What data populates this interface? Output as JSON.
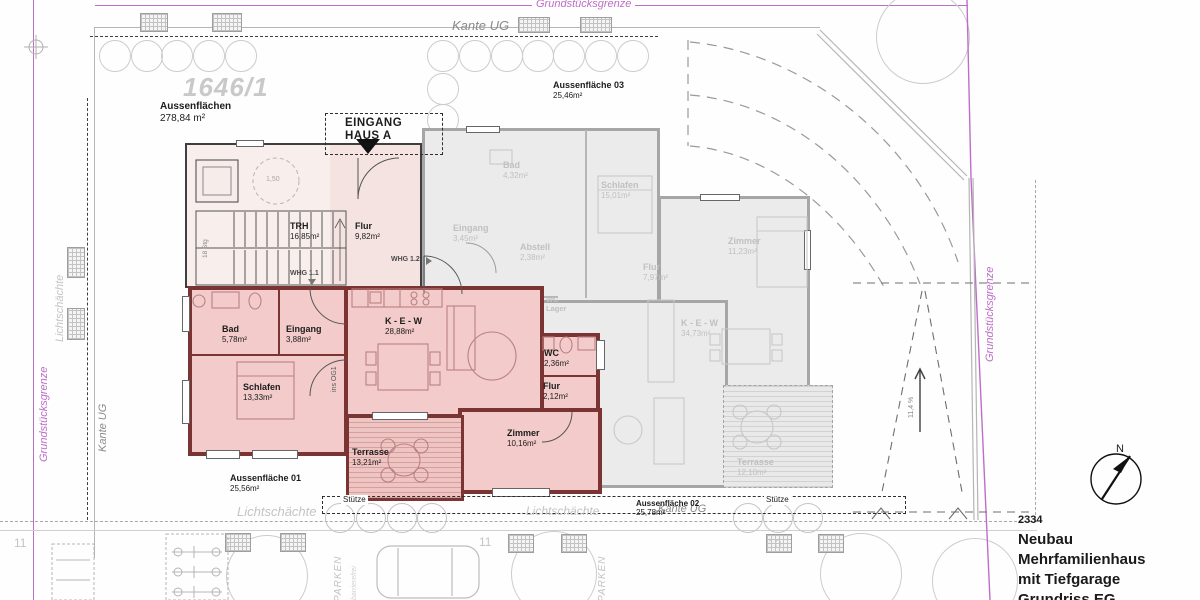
{
  "title_block": {
    "project_no": "2334",
    "line1": "Neubau",
    "line2": "Mehrfamilienhaus",
    "line3": "mit Tiefgarage",
    "line4": "Grundriss EG"
  },
  "compass": {
    "north": "N"
  },
  "boundary": {
    "grundstuecksgrenze": "Grundstücksgrenze",
    "kante_ug": "Kante UG"
  },
  "site": {
    "parcel_no": "1646/1",
    "outdoor_total": {
      "name": "Aussenflächen",
      "area": "278,84 m²"
    },
    "outdoor_01": {
      "name": "Aussenfläche 01",
      "area": "25,56m²"
    },
    "outdoor_02": {
      "name": "Aussenfläche 02",
      "area": "25,78m²"
    },
    "outdoor_03": {
      "name": "Aussenfläche 03",
      "area": "25,46m²"
    },
    "lichtschaechte": "Lichtschächte",
    "stuetze": "Stütze",
    "parken": "PARKEN",
    "barrierefrei": "barrierefrei",
    "ramp_slope": "11,4 %",
    "parking_no_11": "11",
    "parking_no_10": "10"
  },
  "entrance": {
    "line1": "EINGANG",
    "line2": "HAUS A"
  },
  "stairwell": {
    "trh": {
      "name": "TRH",
      "area": "16,85m²"
    },
    "flur": {
      "name": "Flur",
      "area": "9,82m²"
    },
    "turning_circle": "1,50",
    "stairs_note": "18 Stg",
    "to_upper_floor": "ins OG1",
    "whg11_tag": "WHG 1.1",
    "whg12_tag": "WHG 1.2"
  },
  "whg1": {
    "rooms": {
      "bad": {
        "name": "Bad",
        "area": "5,78m²"
      },
      "eingang": {
        "name": "Eingang",
        "area": "3,88m²"
      },
      "schlafen": {
        "name": "Schlafen",
        "area": "13,33m²"
      },
      "kew": {
        "name": "K - E - W",
        "area": "28,88m²"
      },
      "wc": {
        "name": "WC",
        "area": "2,36m²"
      },
      "flur": {
        "name": "Flur",
        "area": "2,12m²"
      },
      "zimmer": {
        "name": "Zimmer",
        "area": "10,16m²"
      },
      "terrasse": {
        "name": "Terrasse",
        "area": "13,21m²"
      }
    }
  },
  "whg2": {
    "rooms": {
      "bad": {
        "name": "Bad",
        "area": "4,32m²"
      },
      "schlafen": {
        "name": "Schlafen",
        "area": "15,01m²"
      },
      "eingang": {
        "name": "Eingang",
        "area": "3,45m²"
      },
      "abstell": {
        "name": "Abstell",
        "area": "2,38m²"
      },
      "wc": {
        "name": "WC"
      },
      "lager": {
        "name": "Lager"
      },
      "flur": {
        "name": "Flur",
        "area": "7,97m²"
      },
      "zimmer": {
        "name": "Zimmer",
        "area": "11,23m²"
      },
      "kew": {
        "name": "K - E - W",
        "area": "34,73m²"
      },
      "terrasse": {
        "name": "Terrasse",
        "area": "12,10m²"
      }
    }
  },
  "colors": {
    "boundary_magenta": "#bd6fc8",
    "apartment_fill": "#f2cbca",
    "apartment_wall": "#7b3434",
    "gray_building": "#ebebeb"
  }
}
